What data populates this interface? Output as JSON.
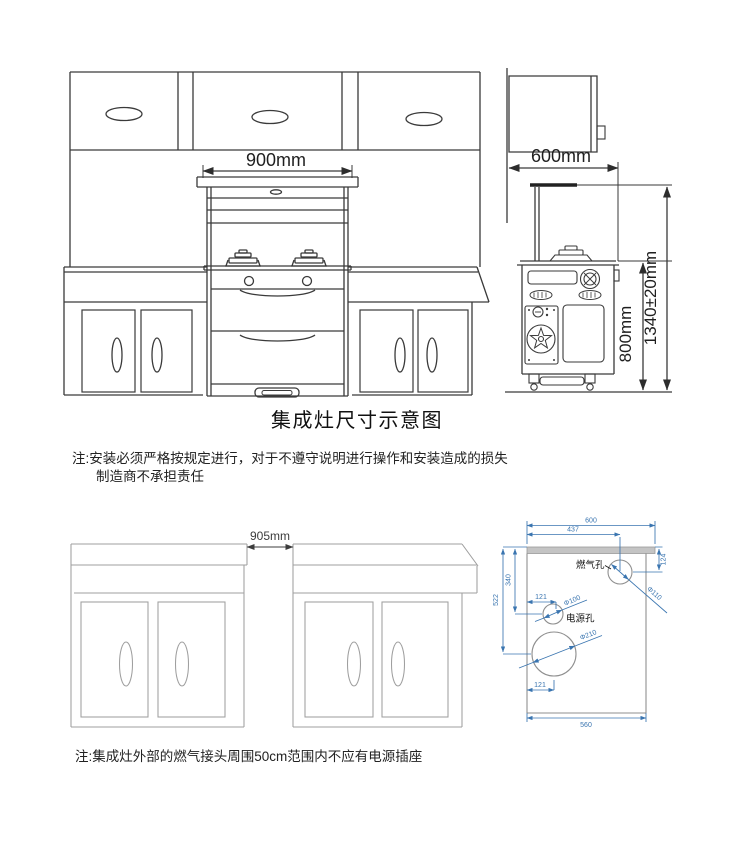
{
  "page": {
    "title": "集成灶尺寸示意图",
    "notes": {
      "install_line1": "注:安装必须严格按规定进行，对于不遵守说明进行操作和安装造成的损失",
      "install_line2": "制造商不承担责任",
      "socket": "注:集成灶外部的燃气接头周围50cm范围内不应有电源插座"
    }
  },
  "front_view": {
    "width_dim": "900mm"
  },
  "side_view": {
    "depth_dim": "600mm",
    "body_height_dim": "800mm",
    "total_height_dim": "1340±20mm"
  },
  "gap_view": {
    "gap_dim": "905mm"
  },
  "cutout_view": {
    "labels": {
      "gas_hole": "燃气孔",
      "power_hole": "电源孔"
    },
    "dims": {
      "top_width": "600",
      "gas_hole_x": "437",
      "gas_hole_y": "124",
      "power_hole_y": "340",
      "drain_hole_y": "522",
      "power_hole_x": "121",
      "drain_hole_x": "121",
      "bottom_width": "560",
      "gas_hole_dia": "Φ110",
      "power_hole_dia": "Φ100",
      "drain_hole_dia": "Φ210"
    }
  },
  "colors": {
    "line_dark": "#3a3a3a",
    "line_gray": "#9f9f9f",
    "dim_blue": "#3a75b0",
    "text": "#1f1f1f",
    "background": "#ffffff"
  }
}
